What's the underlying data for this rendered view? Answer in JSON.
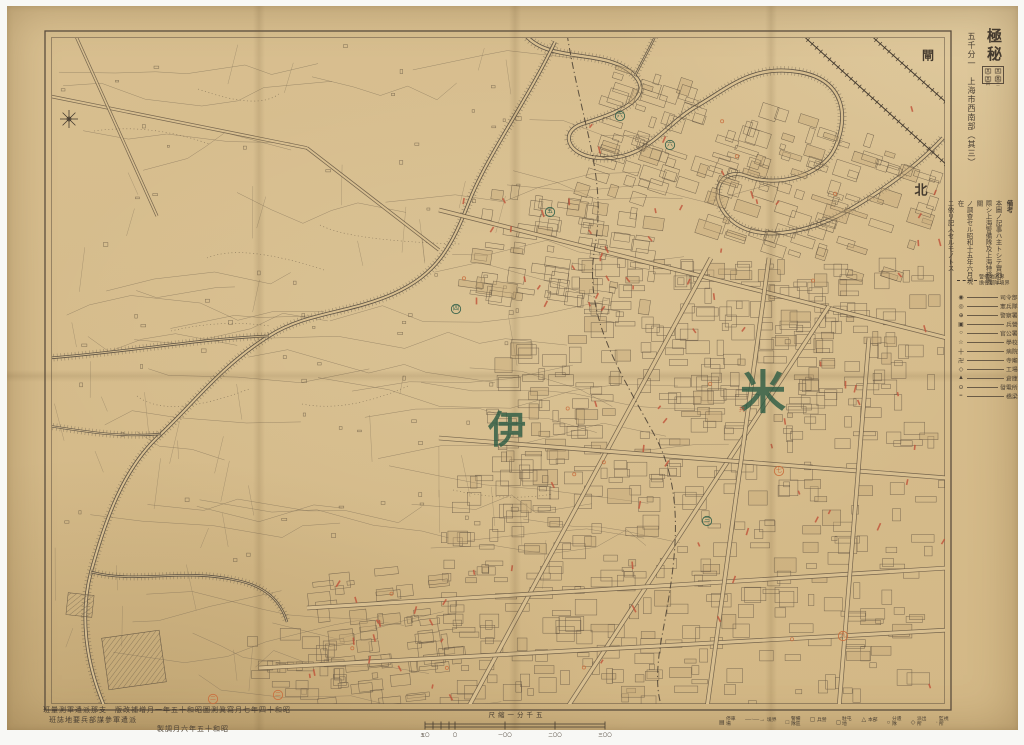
{
  "palette": {
    "paper": "#d8bf90",
    "blockFill": "#c6a877",
    "line": "#6a5b46",
    "lineSoft": "#84735a",
    "dark": "#463c30",
    "green": "#2f5d45",
    "red": "#bf5138",
    "orange": "#c96f3e",
    "frame": "#5b4d3d",
    "creek": "#5e5344"
  },
  "header": {
    "classification": "極秘",
    "series_title": "五千分一　上海市西南部（其三）",
    "keymap": {
      "cells": [
        "其二",
        "其一",
        "其四",
        "其三"
      ],
      "current": "其三"
    }
  },
  "notes": {
    "title": "備考",
    "lines": [
      "本圖ノ記事ハ主トシテ實地ニ",
      "際シ上海警備隊及上海特務機關",
      "ノ調查セル昭和十五年六月現在",
      "ニ依リ記入セルモノトス"
    ]
  },
  "boundary_note": {
    "label_top": "警備地區界",
    "label_bottom": "擔任部隊境界"
  },
  "side_legend": {
    "items": [
      {
        "sym": "◉",
        "label": "司令部"
      },
      {
        "sym": "◎",
        "label": "憲兵隊"
      },
      {
        "sym": "⊕",
        "label": "警察署"
      },
      {
        "sym": "▣",
        "label": "兵營"
      },
      {
        "sym": "○",
        "label": "官公署"
      },
      {
        "sym": "☆",
        "label": "學校"
      },
      {
        "sym": "十",
        "label": "病院"
      },
      {
        "sym": "卍",
        "label": "寺廟"
      },
      {
        "sym": "◇",
        "label": "工場"
      },
      {
        "sym": "▲",
        "label": "倉庫"
      },
      {
        "sym": "⊙",
        "label": "發電所"
      },
      {
        "sym": "≡",
        "label": "橋梁"
      }
    ]
  },
  "bottom_legend": {
    "items": [
      {
        "sym": "▤",
        "label": "停車場"
      },
      {
        "sym": "—·—→",
        "label": "境界"
      },
      {
        "sym": "□",
        "label": "警備隊區"
      },
      {
        "sym": "▢",
        "label": "兵營"
      },
      {
        "sym": "◻",
        "label": "駐屯地"
      },
      {
        "sym": "△",
        "label": "本部"
      },
      {
        "sym": "○",
        "label": "分遣隊"
      },
      {
        "sym": "◇",
        "label": "派出所"
      },
      {
        "sym": "·",
        "label": "監視所"
      }
    ]
  },
  "imprint": {
    "line1": "班量測軍遣派那支　版改補增月一年五十和昭圖測眞寫月七年四十和昭",
    "line2": "班誌地要兵部謀參軍遣派",
    "compiled": "製調月六年五十和昭"
  },
  "scale": {
    "label": "尺縮一分千五",
    "ticks": [
      "五〇",
      "〇",
      "一〇〇",
      "二〇〇",
      "三〇〇"
    ]
  },
  "map_labels": {
    "big": [
      {
        "text": "伊",
        "x": 500,
        "y": 423,
        "size": 38
      },
      {
        "text": "米",
        "x": 756,
        "y": 387,
        "size": 46
      }
    ],
    "small": [
      {
        "text": "閘",
        "x": 921,
        "y": 49,
        "size": 12
      },
      {
        "text": "北",
        "x": 914,
        "y": 183,
        "size": 13
      }
    ],
    "marks": [
      {
        "t": "六",
        "x": 613,
        "y": 110,
        "c": "green"
      },
      {
        "t": "六",
        "x": 663,
        "y": 139,
        "c": "green"
      },
      {
        "t": "五",
        "x": 543,
        "y": 206,
        "c": "green"
      },
      {
        "t": "四",
        "x": 449,
        "y": 303,
        "c": "green"
      },
      {
        "t": "三",
        "x": 700,
        "y": 515,
        "c": "green"
      },
      {
        "t": "二",
        "x": 206,
        "y": 693,
        "c": "orange"
      },
      {
        "t": "二",
        "x": 271,
        "y": 689,
        "c": "orange"
      },
      {
        "t": "九",
        "x": 836,
        "y": 630,
        "c": "orange"
      },
      {
        "t": "七",
        "x": 772,
        "y": 465,
        "c": "orange"
      },
      {
        "t": "共",
        "x": 735,
        "y": 403,
        "c": "red",
        "plain": true
      }
    ]
  }
}
